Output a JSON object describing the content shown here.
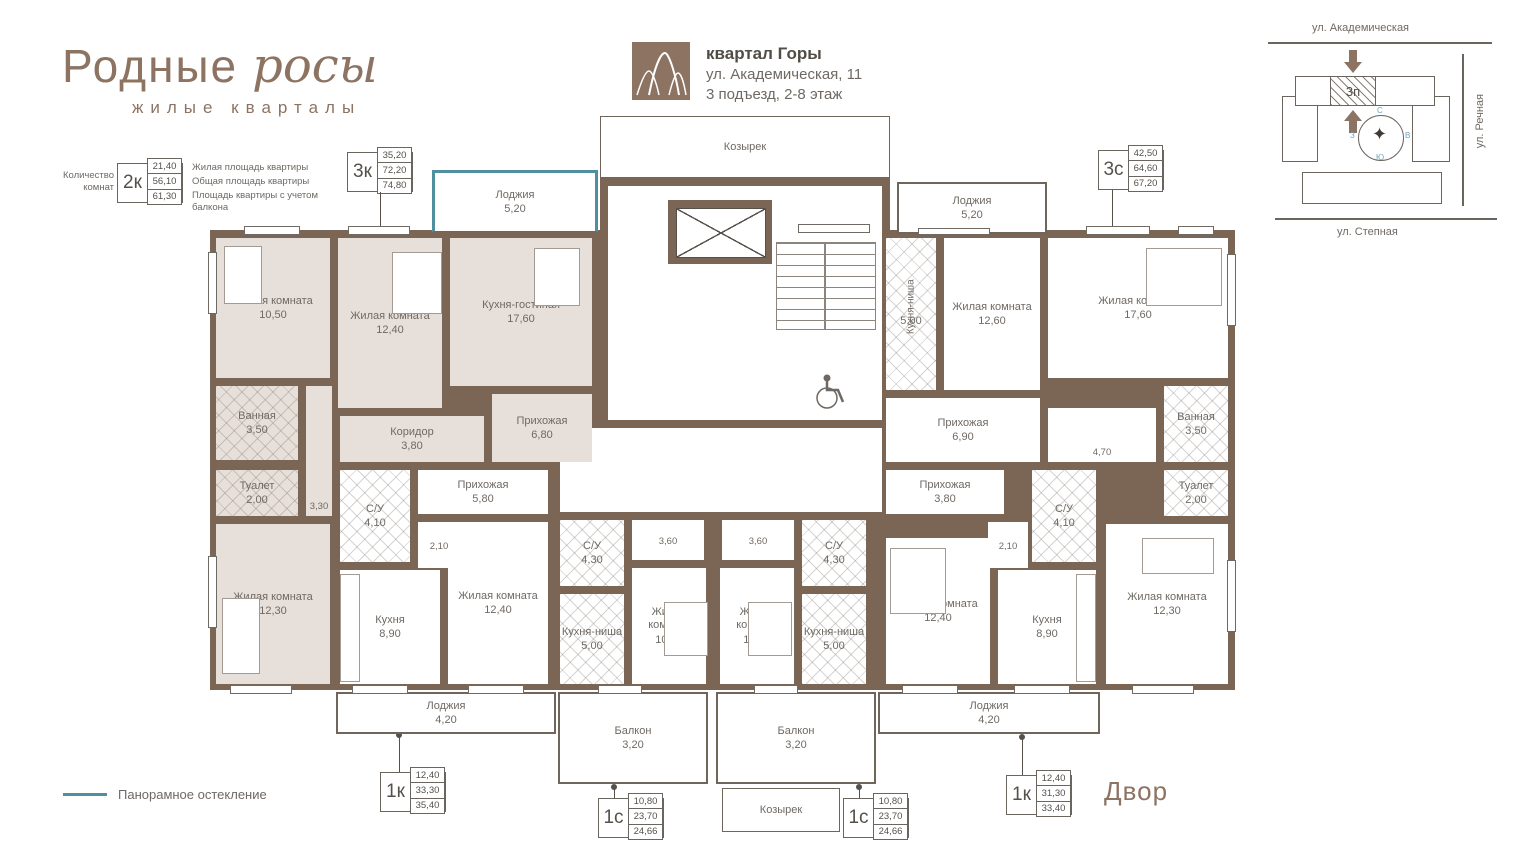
{
  "branding": {
    "title": "Родные",
    "script": "росы",
    "subtitle": "жилые кварталы"
  },
  "header": {
    "project": "квартал Горы",
    "address": "ул. Академическая, 11",
    "entrance": "3 подъезд, 2-8 этаж"
  },
  "site": {
    "street_top": "ул. Академическая",
    "street_right": "ул. Речная",
    "street_bottom": "ул. Степная",
    "section": "3п",
    "compass": {
      "n": "С",
      "e": "В",
      "s": "Ю",
      "w": "З"
    }
  },
  "legend": {
    "rooms_count": "Количество комнат",
    "sample": {
      "type": "2к",
      "values": [
        "21,40",
        "56,10",
        "61,30"
      ]
    },
    "labels": [
      "Жилая площадь квартиры",
      "Общая площадь квартиры",
      "Площадь квартиры с учетом балкона"
    ],
    "panoramic": "Панорамное остекление",
    "courtyard": "Двор"
  },
  "type_boxes": [
    {
      "type": "3к",
      "values": [
        "35,20",
        "72,20",
        "74,80"
      ]
    },
    {
      "type": "3с",
      "values": [
        "42,50",
        "64,60",
        "67,20"
      ]
    },
    {
      "type": "1к",
      "values": [
        "12,40",
        "33,30",
        "35,40"
      ]
    },
    {
      "type": "1с",
      "values": [
        "10,80",
        "23,70",
        "24,66"
      ]
    },
    {
      "type": "1с",
      "values": [
        "10,80",
        "23,70",
        "24,66"
      ]
    },
    {
      "type": "1к",
      "values": [
        "12,40",
        "31,30",
        "33,40"
      ]
    }
  ],
  "plan": {
    "masses": [
      [
        210,
        230,
        1025,
        460
      ],
      [
        600,
        178,
        290,
        58
      ]
    ],
    "rooms": [
      {
        "id": "kozyrek-top",
        "cls": "open canopy",
        "name": "Козырек",
        "rect": [
          600,
          116,
          290,
          62
        ]
      },
      {
        "id": "lodzhiya-3k",
        "cls": "open panoramic",
        "name": "Лоджия",
        "area": "5,20",
        "rect": [
          432,
          170,
          166,
          62
        ]
      },
      {
        "id": "lodzhiya-3s",
        "cls": "open",
        "name": "Лоджия",
        "area": "5,20",
        "rect": [
          897,
          182,
          150,
          52
        ]
      },
      {
        "id": "hall",
        "cls": "",
        "rect": [
          608,
          186,
          274,
          234
        ]
      },
      {
        "id": "corridor-common",
        "cls": "",
        "rect": [
          560,
          428,
          322,
          84
        ]
      },
      {
        "id": "zhilaya-10-50",
        "cls": "beige",
        "name": "Жилая комната",
        "area": "10,50",
        "rect": [
          216,
          238,
          114,
          140
        ]
      },
      {
        "id": "zhilaya-12-40-3k",
        "cls": "beige",
        "name": "Жилая комната",
        "area": "12,40",
        "rect": [
          338,
          238,
          104,
          170
        ]
      },
      {
        "id": "kuhnya-gostinaya-3k",
        "cls": "beige",
        "name": "Кухня-гостиная",
        "area": "17,60",
        "rect": [
          450,
          238,
          142,
          148
        ]
      },
      {
        "id": "vannaya-3k",
        "cls": "hatch beige",
        "name": "Ванная",
        "area": "3,50",
        "rect": [
          216,
          386,
          82,
          74
        ]
      },
      {
        "id": "koridor-3-30",
        "cls": "beige small lb",
        "area": "3,30",
        "rect": [
          306,
          386,
          26,
          130
        ]
      },
      {
        "id": "koridor-3k",
        "cls": "beige",
        "name": "Коридор",
        "area": "3,80",
        "rect": [
          340,
          416,
          144,
          46
        ]
      },
      {
        "id": "prihozhaya-3k",
        "cls": "beige",
        "name": "Прихожая",
        "area": "6,80",
        "rect": [
          492,
          394,
          100,
          68
        ]
      },
      {
        "id": "tualet-3k",
        "cls": "hatch beige",
        "name": "Туалет",
        "area": "2,00",
        "rect": [
          216,
          470,
          82,
          46
        ]
      },
      {
        "id": "zhilaya-12-30-3k",
        "cls": "beige",
        "name": "Жилая комната",
        "area": "12,30",
        "rect": [
          216,
          524,
          114,
          160
        ]
      },
      {
        "id": "su-1k-left",
        "cls": "hatch",
        "name": "С/У",
        "area": "4,10",
        "rect": [
          340,
          470,
          70,
          92
        ]
      },
      {
        "id": "prihozhaya-1k-left",
        "cls": "",
        "name": "Прихожая",
        "area": "5,80",
        "rect": [
          418,
          470,
          130,
          44
        ]
      },
      {
        "id": "koridor-2-10-left",
        "cls": "small",
        "area": "2,10",
        "rect": [
          418,
          522,
          42,
          46
        ]
      },
      {
        "id": "kuhnya-1k-left",
        "cls": "",
        "name": "Кухня",
        "area": "8,90",
        "rect": [
          340,
          570,
          100,
          114
        ]
      },
      {
        "id": "zhilaya-1k-left",
        "cls": "",
        "name": "Жилая комната",
        "area": "12,40",
        "rect": [
          448,
          522,
          100,
          162
        ]
      },
      {
        "id": "su-1s-left",
        "cls": "hatch",
        "name": "С/У",
        "area": "4,30",
        "rect": [
          560,
          520,
          64,
          66
        ]
      },
      {
        "id": "hall-3-60-left",
        "cls": "small",
        "area": "3,60",
        "rect": [
          632,
          520,
          72,
          40
        ]
      },
      {
        "id": "zhilaya-1s-left",
        "cls": "",
        "name": "Жилая комната",
        "area": "10,80",
        "rect": [
          632,
          568,
          74,
          116
        ]
      },
      {
        "id": "kuhnya-nisha-1s-left",
        "cls": "hatch",
        "name": "Кухня-ниша",
        "area": "5,00",
        "rect": [
          560,
          594,
          64,
          90
        ]
      },
      {
        "id": "hall-3-60-right",
        "cls": "small",
        "area": "3,60",
        "rect": [
          722,
          520,
          72,
          40
        ]
      },
      {
        "id": "su-1s-right",
        "cls": "hatch",
        "name": "С/У",
        "area": "4,30",
        "rect": [
          802,
          520,
          64,
          66
        ]
      },
      {
        "id": "zhilaya-1s-right",
        "cls": "",
        "name": "Жилая комната",
        "area": "10,80",
        "rect": [
          720,
          568,
          74,
          116
        ]
      },
      {
        "id": "kuhnya-nisha-1s-right",
        "cls": "hatch",
        "name": "Кухня-ниша",
        "area": "5,00",
        "rect": [
          802,
          594,
          64,
          90
        ]
      },
      {
        "id": "kuhnya-nisha-3s",
        "cls": "hatch",
        "name": "Кухня-ниша",
        "area": "5,00",
        "vertical": true,
        "rect": [
          886,
          238,
          50,
          152
        ]
      },
      {
        "id": "zhilaya-12-60-3s",
        "cls": "",
        "name": "Жилая комната",
        "area": "12,60",
        "rect": [
          944,
          238,
          96,
          152
        ]
      },
      {
        "id": "zhilaya-17-60-3s",
        "cls": "",
        "name": "Жилая комната",
        "area": "17,60",
        "rect": [
          1048,
          238,
          180,
          140
        ]
      },
      {
        "id": "prihozhaya-3s",
        "cls": "",
        "name": "Прихожая",
        "area": "6,90",
        "rect": [
          886,
          398,
          154,
          64
        ]
      },
      {
        "id": "koridor-4-70",
        "cls": "small lb",
        "area": "4,70",
        "rect": [
          1048,
          408,
          108,
          54
        ]
      },
      {
        "id": "vannaya-3s",
        "cls": "hatch",
        "name": "Ванная",
        "area": "3,50",
        "rect": [
          1164,
          386,
          64,
          76
        ]
      },
      {
        "id": "tualet-3s",
        "cls": "hatch",
        "name": "Туалет",
        "area": "2,00",
        "rect": [
          1164,
          470,
          64,
          46
        ]
      },
      {
        "id": "zhilaya-12-30-3s",
        "cls": "",
        "name": "Жилая комната",
        "area": "12,30",
        "rect": [
          1106,
          524,
          122,
          160
        ]
      },
      {
        "id": "prihozhaya-1k-right",
        "cls": "",
        "name": "Прихожая",
        "area": "3,80",
        "rect": [
          886,
          470,
          118,
          44
        ]
      },
      {
        "id": "koridor-2-10-right",
        "cls": "small",
        "area": "2,10",
        "rect": [
          988,
          522,
          40,
          46
        ]
      },
      {
        "id": "su-1k-right",
        "cls": "hatch",
        "name": "С/У",
        "area": "4,10",
        "rect": [
          1032,
          470,
          64,
          92
        ]
      },
      {
        "id": "zhilaya-1k-right",
        "cls": "",
        "name": "Жилая комната",
        "area": "12,40",
        "rect": [
          886,
          538,
          104,
          146
        ]
      },
      {
        "id": "kuhnya-1k-right",
        "cls": "",
        "name": "Кухня",
        "area": "8,90",
        "rect": [
          998,
          570,
          98,
          114
        ]
      },
      {
        "id": "lodzhiya-1k-left",
        "cls": "open",
        "name": "Лоджия",
        "area": "4,20",
        "rect": [
          336,
          692,
          220,
          42
        ]
      },
      {
        "id": "balkon-left",
        "cls": "open",
        "name": "Балкон",
        "area": "3,20",
        "rect": [
          558,
          692,
          150,
          92
        ]
      },
      {
        "id": "balkon-right",
        "cls": "open",
        "name": "Балкон",
        "area": "3,20",
        "rect": [
          716,
          692,
          160,
          92
        ]
      },
      {
        "id": "lodzhiya-1k-right",
        "cls": "open",
        "name": "Лоджия",
        "area": "4,20",
        "rect": [
          878,
          692,
          222,
          42
        ]
      },
      {
        "id": "kozyrek-bottom",
        "cls": "open canopy",
        "name": "Козырек",
        "rect": [
          722,
          788,
          118,
          44
        ]
      }
    ],
    "windows": [
      [
        244,
        226,
        56,
        9
      ],
      [
        348,
        226,
        62,
        9
      ],
      [
        918,
        228,
        72,
        7
      ],
      [
        1086,
        226,
        64,
        9
      ],
      [
        1178,
        226,
        36,
        9
      ],
      [
        208,
        252,
        9,
        62
      ],
      [
        208,
        556,
        9,
        72
      ],
      [
        1227,
        254,
        9,
        72
      ],
      [
        1227,
        560,
        9,
        72
      ],
      [
        230,
        685,
        62,
        9
      ],
      [
        352,
        685,
        56,
        9
      ],
      [
        468,
        685,
        56,
        9
      ],
      [
        598,
        685,
        44,
        9
      ],
      [
        754,
        685,
        44,
        9
      ],
      [
        902,
        685,
        56,
        9
      ],
      [
        1014,
        685,
        56,
        9
      ],
      [
        1132,
        685,
        62,
        9
      ],
      [
        798,
        224,
        72,
        9
      ]
    ],
    "furniture": [
      [
        224,
        246,
        38,
        58
      ],
      [
        392,
        252,
        50,
        62
      ],
      [
        534,
        248,
        46,
        58
      ],
      [
        1146,
        248,
        76,
        58
      ],
      [
        222,
        598,
        38,
        76
      ],
      [
        1142,
        538,
        72,
        36
      ],
      [
        664,
        602,
        44,
        54
      ],
      [
        748,
        602,
        44,
        54
      ],
      [
        890,
        548,
        56,
        66
      ],
      [
        340,
        574,
        20,
        108
      ],
      [
        1076,
        574,
        20,
        108
      ]
    ]
  }
}
